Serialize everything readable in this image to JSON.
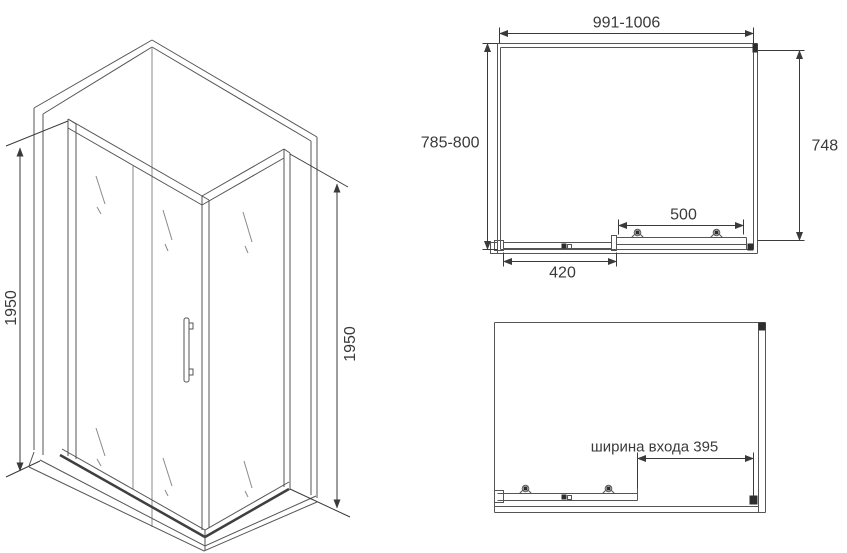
{
  "colors": {
    "line": "#555555",
    "dimension_line": "#3a3a3a",
    "text": "#3a3a3a",
    "background": "#ffffff"
  },
  "iso_view": {
    "height_left": "1950",
    "height_right": "1950"
  },
  "top_view": {
    "overall_width": "991-1006",
    "overall_depth": "785-800",
    "side_panel": "748",
    "door_travel": "500",
    "fixed_panel": "420"
  },
  "open_view": {
    "entry_width": "ширина входа 395"
  }
}
